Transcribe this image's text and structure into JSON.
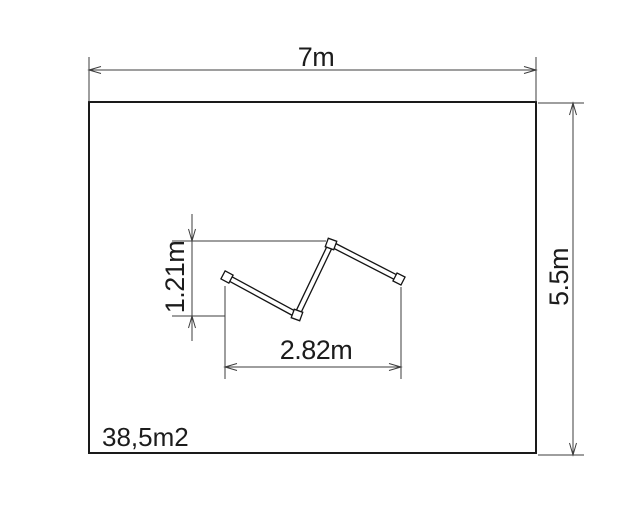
{
  "labels": {
    "room_width": "7m",
    "room_height": "5.5m",
    "partition_height": "1.21m",
    "partition_width": "2.82m",
    "room_area": "38,5m2"
  },
  "colors": {
    "outline": "#1a1a1a",
    "dimension": "#3c3c3c",
    "background": "#ffffff"
  }
}
